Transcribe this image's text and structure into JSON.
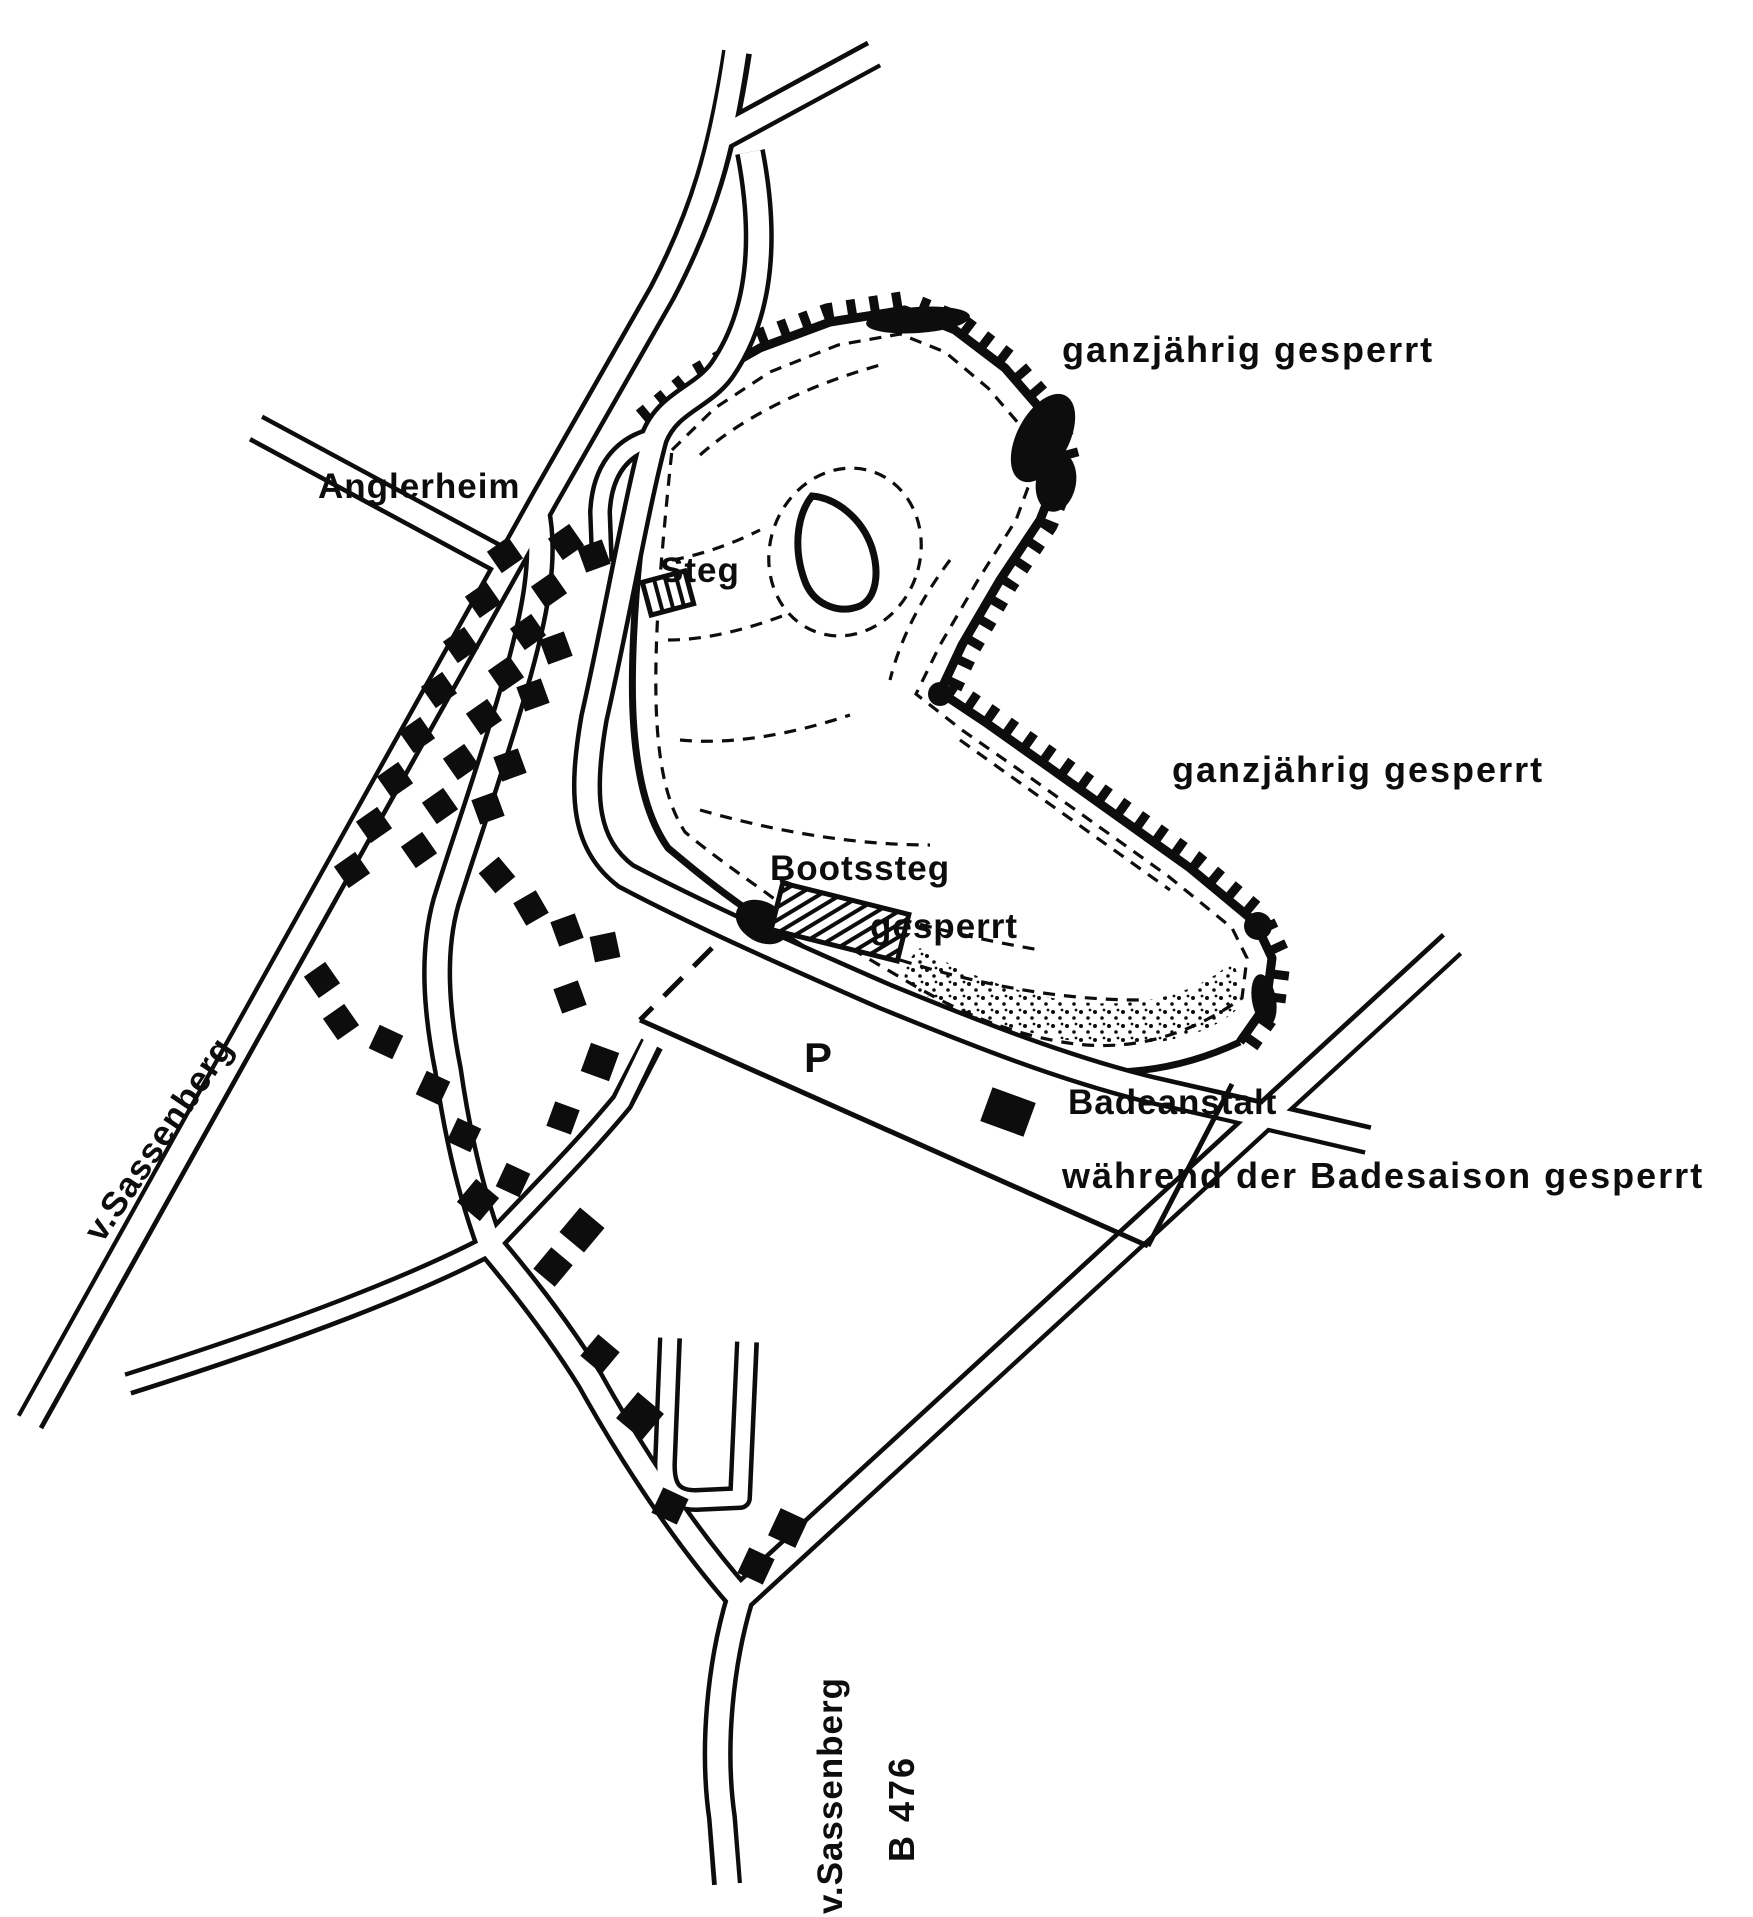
{
  "map": {
    "colors": {
      "ink": "#0d0d0d",
      "paper": "#ffffff"
    },
    "labels": {
      "anglerheim": "Anglerheim",
      "steg": "Steg",
      "closed_year_round_north": "ganzjährig gesperrt",
      "closed_year_round_east": "ganzjährig gesperrt",
      "bootssteg": "Bootssteg",
      "bootssteg_status": "gesperrt",
      "parking": "P",
      "badeanstalt": "Badeanstalt",
      "bathing_season_note": "während der Badesaison gesperrt",
      "road_from_sassenberg_west": "v.Sassenberg",
      "road_from_sassenberg_south": "v.Sassenberg",
      "federal_road": "B 476"
    }
  }
}
